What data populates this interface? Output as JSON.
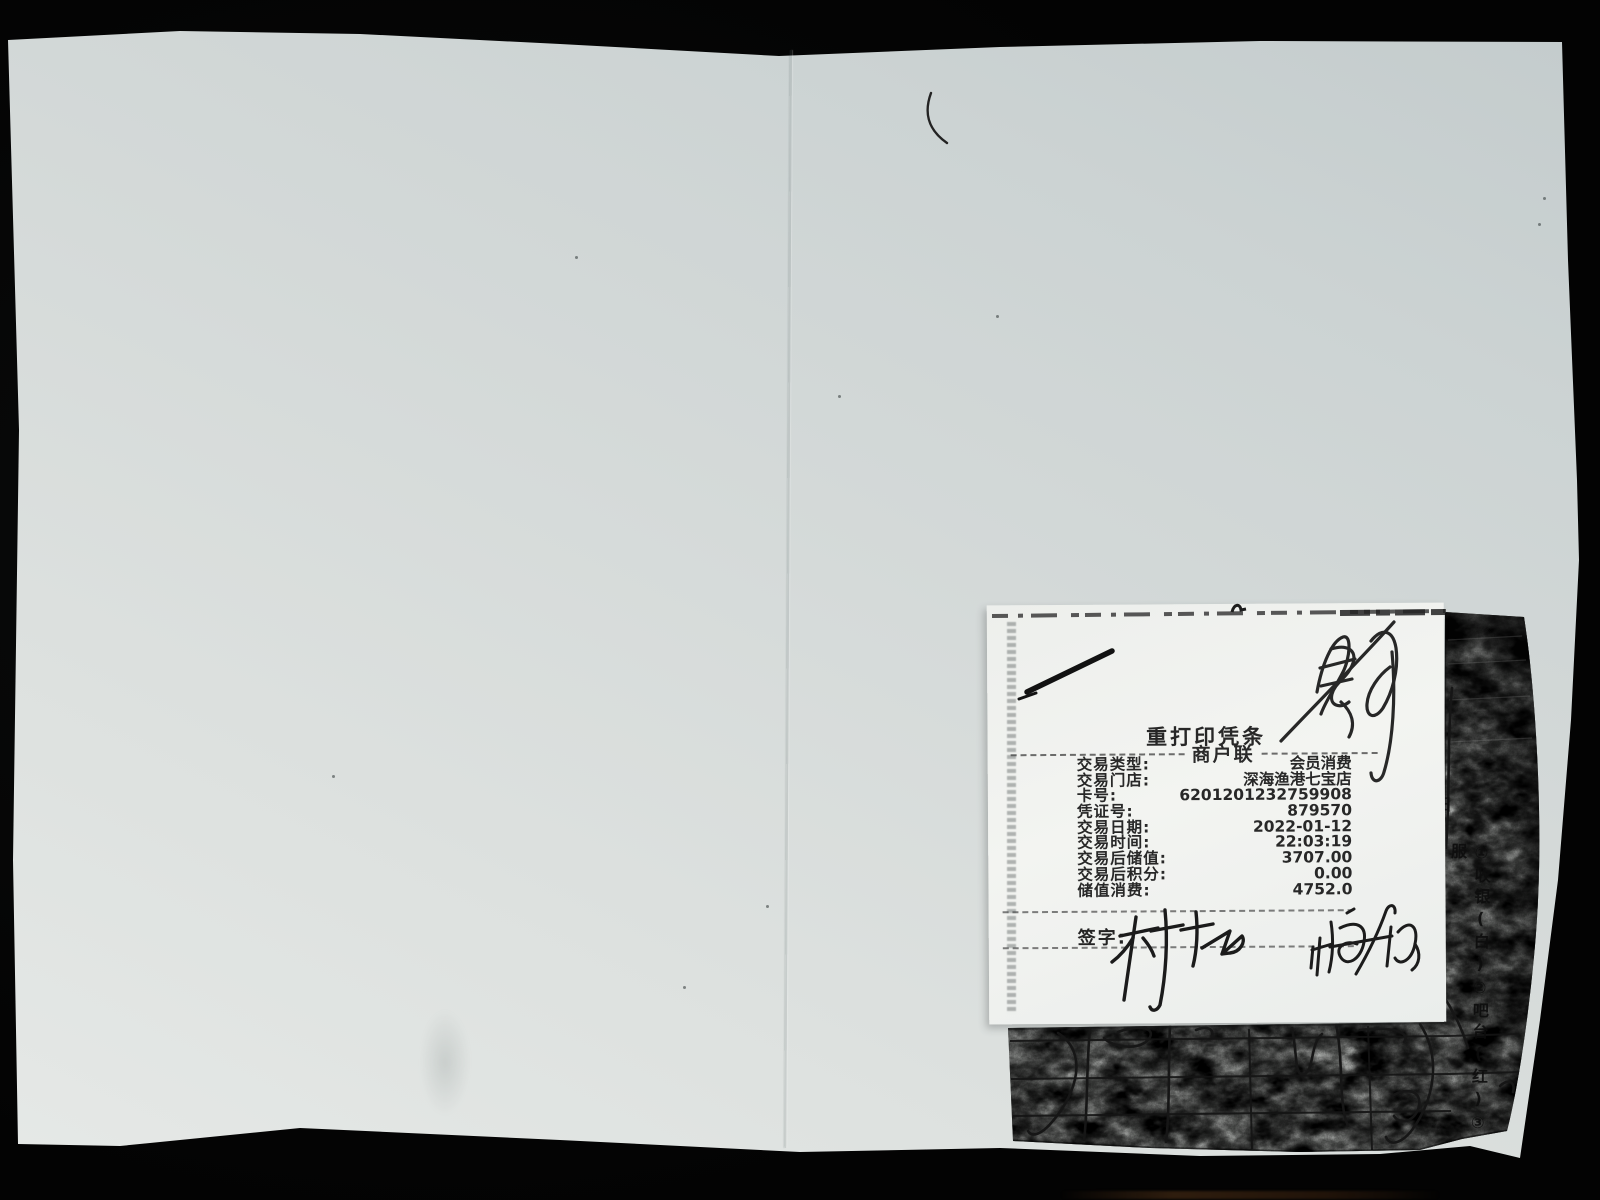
{
  "receipt": {
    "title": "重打印凭条",
    "subtitle": "商户联",
    "rows": [
      {
        "label": "交易类型:",
        "value": "会员消费"
      },
      {
        "label": "交易门店:",
        "value": "深海渔港七宝店"
      },
      {
        "label": "卡号:",
        "value": "6201201232759908"
      },
      {
        "label": "凭证号:",
        "value": "879570"
      },
      {
        "label": "交易日期:",
        "value": "2022-01-12"
      },
      {
        "label": "交易时间:",
        "value": "22:03:19"
      },
      {
        "label": "交易后储值:",
        "value": "3707.00"
      },
      {
        "label": "交易后积分:",
        "value": "0.00"
      },
      {
        "label": "储值消费:",
        "value": "4752.0"
      }
    ],
    "signature_label": "签字:"
  },
  "carbon_copy": {
    "corner_char": "日",
    "side_text": "①收银(白)②吧台(红)③服"
  },
  "colors": {
    "background": "#030303",
    "paper_dark": "#c3cbcc",
    "paper_light": "#e6e9e7",
    "receipt_paper": "#f3f4f1",
    "print_ink": "#272727",
    "pen_ink": "#1b1b1b",
    "carbon_base": "#585a58"
  }
}
